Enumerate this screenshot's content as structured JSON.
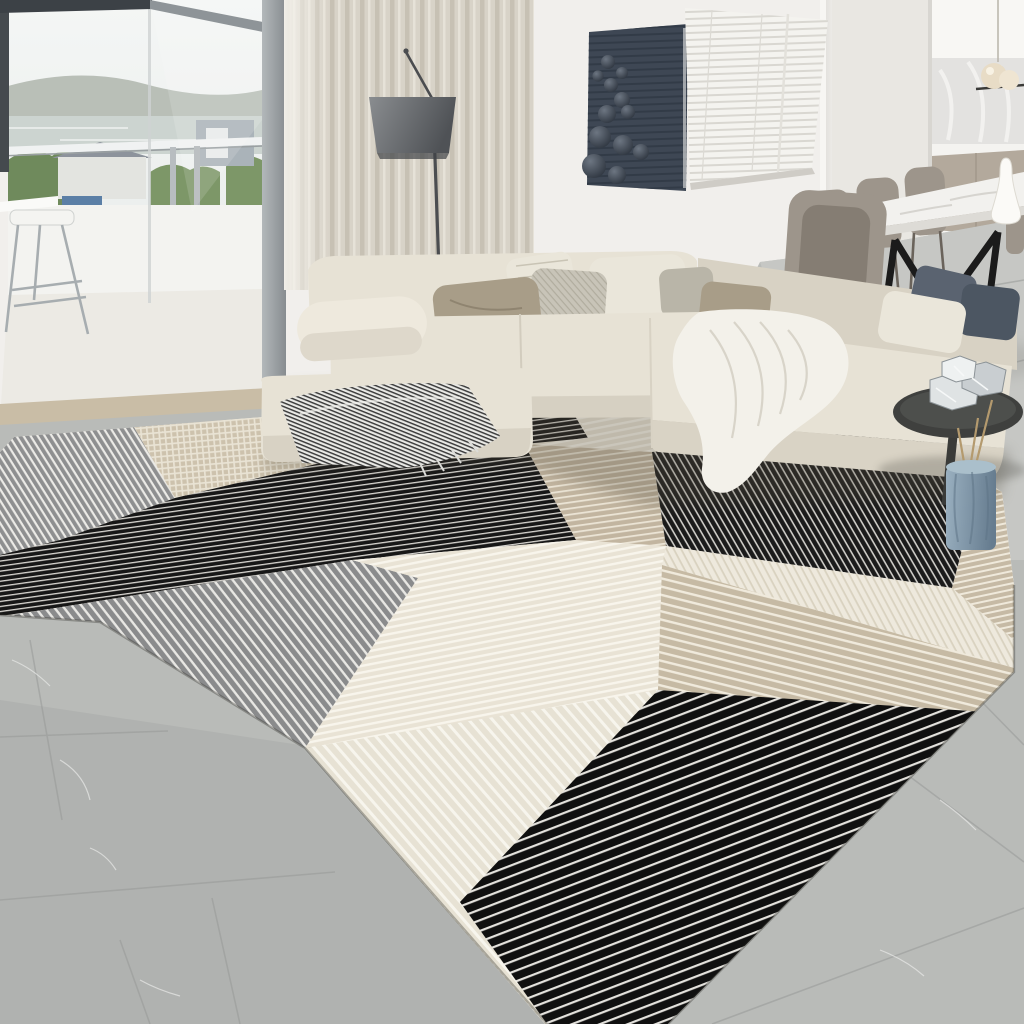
{
  "meta": {
    "title": "Living room with geometric patchwork rug",
    "type": "interior product photo",
    "dimensions": "1024x1024"
  },
  "palette": {
    "wall": "#f1efec",
    "wall_right": "#f7f6f3",
    "wall_recessed": "#e9e7e2",
    "floor": "#b9bbb8",
    "floor_dining": "#c9cac7",
    "floor_dark": "#a7a9a8",
    "sky": "#f0f2f1",
    "hills": "#b2b9b0",
    "water": "#ccd4d0",
    "greenery": "#7d9768",
    "greenery_dark": "#6f8a5c",
    "parapet": "#f3f3f0",
    "balcony_floor": "#eceae4",
    "threshold": "#c9bda6",
    "curtain": "#d8d3c8",
    "lamp_pole": "#4b4d50",
    "art_panel": "#3e4754",
    "blinds": "#f4f3ef",
    "cabinets_lower": "#b3a99c",
    "counter": "#f4f3f0",
    "backsplash": "#e3e2e0",
    "pendant": "#e8dcc6",
    "marble_table": "#f2f1ee",
    "chair": "#9d958b",
    "chair_dark": "#857d73",
    "table_legs": "#1b1b1b",
    "sofa": "#e7e2d5",
    "sofa_shade": "#d8d2c4",
    "pillow_taupe": "#a89d88",
    "pillow_cream": "#eae6da",
    "pillow_herringbone": "#c8c4b8",
    "pillow_slate": "#5a6370",
    "pillow_slate_dark": "#4c5662",
    "throw_white": "#f3f1ea",
    "rug_cream": "#e9e3d5",
    "rug_beige": "#c4b8a2",
    "rug_gray": "#8c8d8e",
    "rug_black": "#161616",
    "vase_blue": "#7e97a9",
    "stems": "#b49a6e",
    "side_table": "#3f403e",
    "crystal": "#dfe3e4"
  },
  "scene": {
    "window": {
      "label": "floor-to-ceiling window with balcony view",
      "view_elements": [
        "overcast sky",
        "distant hills",
        "lake water",
        "green trees and hedges",
        "white house with gray roof",
        "blue tarp",
        "balcony parapet",
        "steel railing posts",
        "metal bar stool",
        "white ledge table"
      ]
    },
    "curtain": {
      "label": "beige linen curtain panel"
    },
    "floor_lamp": {
      "label": "arc floor lamp with gray drum shade"
    },
    "wall_art": {
      "label": "dark slate wall panel with 3D spheres",
      "sphere_count": 12
    },
    "blinds_window": {
      "label": "window with white venetian blinds"
    },
    "kitchen": {
      "label": "open kitchen",
      "elements": [
        "white upper cabinets",
        "marble backsplash",
        "taupe lower cabinets",
        "globe pendant light",
        "white counter"
      ]
    },
    "dining": {
      "label": "dining corner",
      "table": "white marble dining table with black steel legs",
      "chairs": "taupe leather dining chairs",
      "chair_count": 4,
      "decor": [
        "white ceramic carafe"
      ]
    },
    "side_table": {
      "label": "round smoked-glass side table",
      "decor": [
        "crystal glass ornaments",
        "blue ceramic floor vase",
        "dried stems"
      ]
    },
    "sofa": {
      "label": "L-shaped cream sectional sofa",
      "pillow_count": 10,
      "throws": [
        "gray striped fringed throw",
        "white knit throw"
      ]
    },
    "rug": {
      "label": "geometric patchwork area rug",
      "patches": [
        "gray pinstripe",
        "beige check",
        "black pinstripe",
        "cream stripe",
        "gray stripe",
        "black pinstripe panel",
        "beige stripe",
        "white stripe",
        "beige diagonal band",
        "cream rib",
        "black rib"
      ]
    },
    "floor": {
      "label": "gray marble tile floor"
    }
  }
}
